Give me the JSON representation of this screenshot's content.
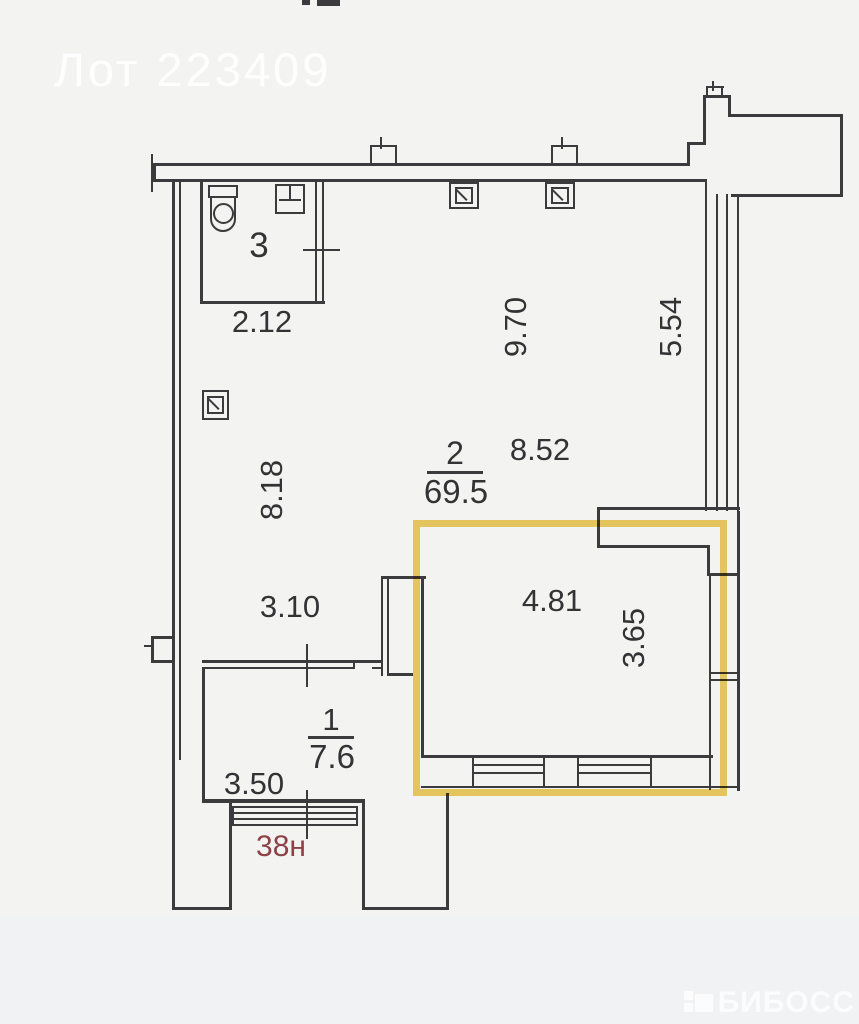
{
  "watermark": {
    "lot_label": "Лот 223409"
  },
  "brand": {
    "name": "БИБОСС"
  },
  "rooms": {
    "bathroom": {
      "number": "3"
    },
    "main": {
      "number": "2",
      "area": "69.5"
    },
    "hall": {
      "number": "1",
      "area": "7.6"
    }
  },
  "dimensions": {
    "d212": "2.12",
    "d970": "9.70",
    "d554": "5.54",
    "d818": "8.18",
    "d852": "8.52",
    "d310": "3.10",
    "d481": "4.81",
    "d365": "3.65",
    "d350": "3.50"
  },
  "unit_label": "38н",
  "colors": {
    "highlight": "#eec84c",
    "annotation": "#8d4246",
    "line": "#3b3b3d"
  }
}
